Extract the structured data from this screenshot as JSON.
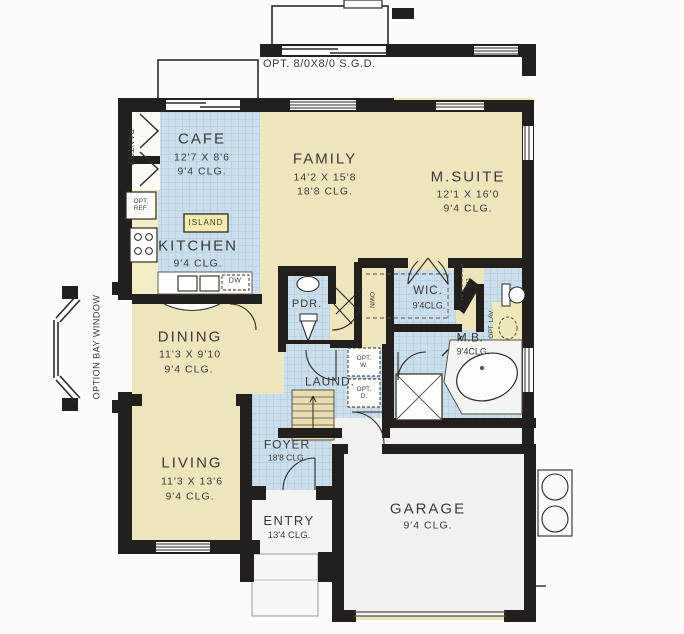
{
  "annotations": {
    "opt_sgd": "OPT. 8/0X8/0 S.G.D.",
    "option_bay_window": "OPTION BAY WINDOW"
  },
  "rooms": [
    {
      "id": "cafe",
      "name": "CAFE",
      "dims": "12'7 X 8'6",
      "clg": "9'4 CLG."
    },
    {
      "id": "family",
      "name": "FAMILY",
      "dims": "14'2 X 15'8",
      "clg": "18'8 CLG."
    },
    {
      "id": "msuite",
      "name": "M.SUITE",
      "dims": "12'1 X 16'0",
      "clg": "9'4 CLG."
    },
    {
      "id": "kitchen",
      "name": "KITCHEN",
      "dims": "",
      "clg": "9'4 CLG."
    },
    {
      "id": "dining",
      "name": "DINING",
      "dims": "11'3 X 9'10",
      "clg": "9'4 CLG."
    },
    {
      "id": "living",
      "name": "LIVING",
      "dims": "11'3 X 13'6",
      "clg": "9'4 CLG."
    },
    {
      "id": "pdr",
      "name": "PDR."
    },
    {
      "id": "wic",
      "name": "WIC.",
      "clg": "9'4CLG."
    },
    {
      "id": "mb",
      "name": "M.B.",
      "clg": "9'4CLG."
    },
    {
      "id": "laund",
      "name": "LAUND."
    },
    {
      "id": "foyer",
      "name": "FOYER",
      "clg": "18'8 CLG."
    },
    {
      "id": "entry",
      "name": "ENTRY",
      "clg": "13'4 CLG."
    },
    {
      "id": "garage",
      "name": "GARAGE",
      "clg": "9'4 CLG."
    }
  ],
  "labels": {
    "pantry": "PANTRY",
    "opt_ref": "OPT. REF.",
    "island": "ISLAND",
    "dw": "DW",
    "own": "OWN",
    "lin": "LIN",
    "opt_w": "OPT. W.",
    "opt_d": "OPT. D.",
    "opt_lav": "OPT. LAV."
  },
  "colors": {
    "wall": "#231f1c",
    "tile": "#cbdeeb",
    "tile_grid": "#a6c3d6",
    "beige": "#efe5bc",
    "garage_floor": "#f1f1ed",
    "counter": "#f4eec6",
    "island_fill": "#f3ecae"
  }
}
